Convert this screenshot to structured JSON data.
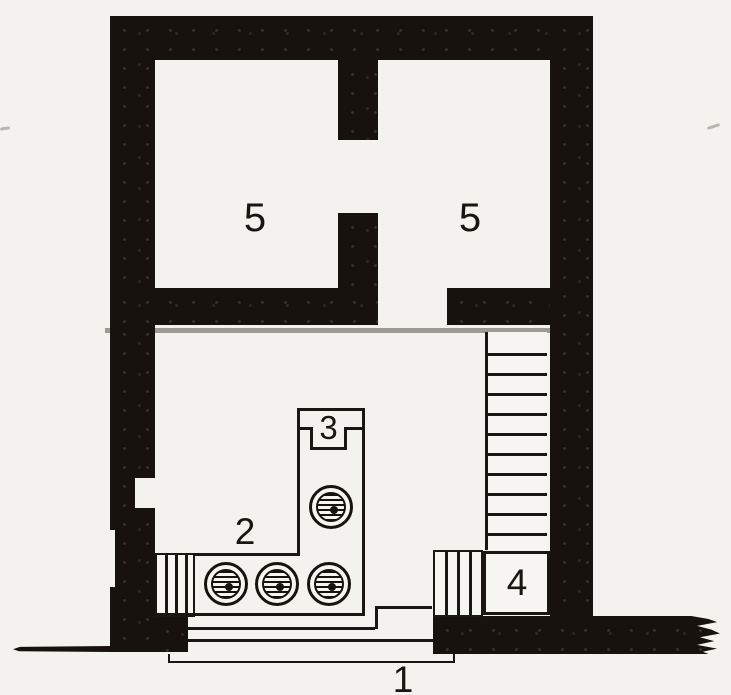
{
  "figure": {
    "labels": {
      "terrace": "1",
      "court": "2",
      "hearth": "3",
      "side_room": "4",
      "upper_room_left": "5",
      "upper_room_right": "5"
    },
    "colors": {
      "paper": "#f3f2ee",
      "ink": "#17120d",
      "phase_line": "#9c9a94"
    }
  }
}
